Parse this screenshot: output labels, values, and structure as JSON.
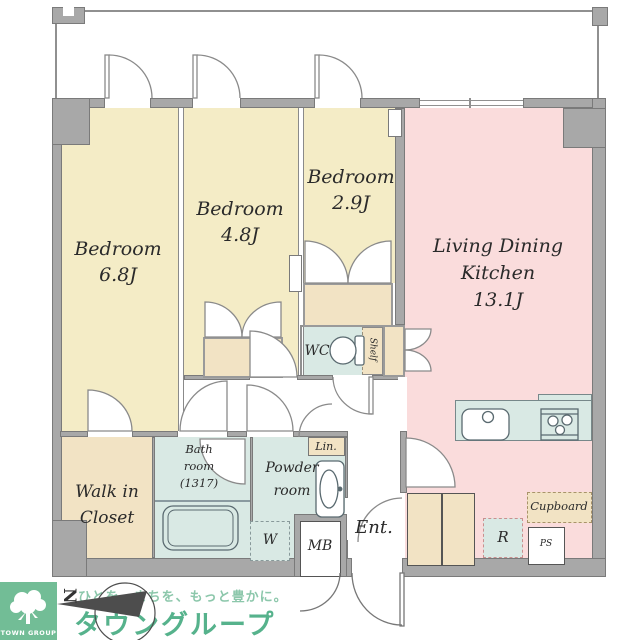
{
  "title": "apartment floor plan",
  "rooms": {
    "bedroom1": {
      "name": "Bedroom",
      "size": "6.8J"
    },
    "bedroom2": {
      "name": "Bedroom",
      "size": "4.8J"
    },
    "bedroom3": {
      "name": "Bedroom",
      "size": "2.9J"
    },
    "ldk": {
      "name1": "Living Dining",
      "name2": "Kitchen",
      "size": "13.1J"
    },
    "wic": {
      "name1": "Walk in",
      "name2": "Closet"
    },
    "bath": {
      "name1": "Bath",
      "name2": "room",
      "size": "(1317)"
    },
    "powder": {
      "name1": "Powder",
      "name2": "room"
    },
    "wc": "WC",
    "ent": "Ent."
  },
  "fixtures": {
    "shelf": "Shelf",
    "linen": "Lin.",
    "washer": "W",
    "meter_box": "MB",
    "fridge": "R",
    "cupboard": "Cupboard",
    "pipe_space": "PS"
  },
  "branding": {
    "company_en": "TOWN GROUP",
    "tagline": "ひとを、まちを、もっと豊かに。",
    "company_jp": "タウングループ",
    "compass_north": "N"
  },
  "colors": {
    "bedroom": "#f4ecc6",
    "ldk_pink": "#fadcdc",
    "wet_teal": "#d9e9e4",
    "closet_tan": "#f2e3c4",
    "wall_gray": "#a8a8a8",
    "brand_green": "#56b28c"
  }
}
